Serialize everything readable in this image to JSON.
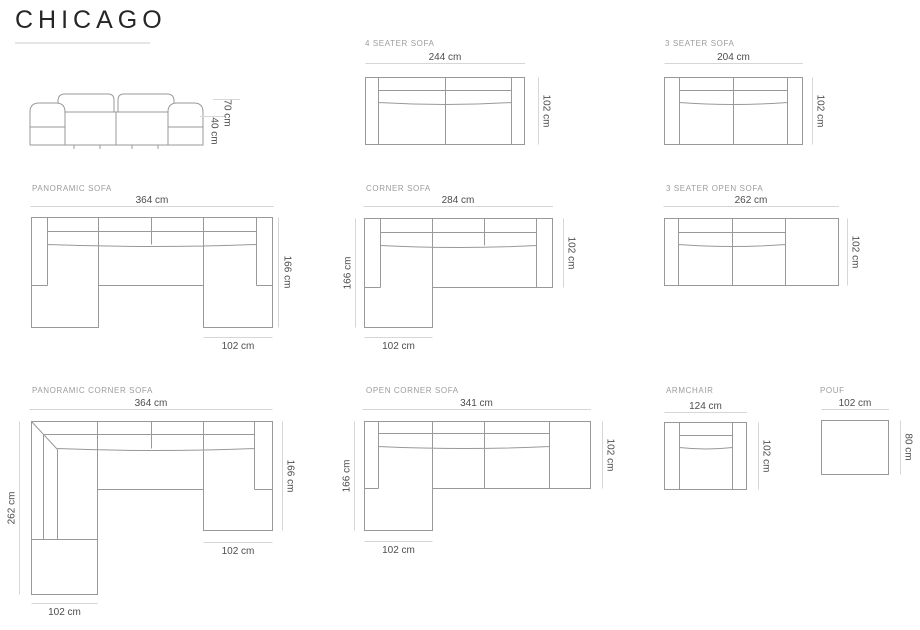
{
  "title": "CHICAGO",
  "side_view": {
    "total_height": "70 cm",
    "seat_height": "40 cm"
  },
  "diagrams": {
    "four_seater": {
      "label": "4 SEATER SOFA",
      "width": "244 cm",
      "depth": "102 cm"
    },
    "three_seater": {
      "label": "3 SEATER SOFA",
      "width": "204 cm",
      "depth": "102 cm"
    },
    "panoramic": {
      "label": "PANORAMIC SOFA",
      "width": "364 cm",
      "depth": "166 cm",
      "chaise_width": "102 cm"
    },
    "corner": {
      "label": "CORNER SOFA",
      "width": "284 cm",
      "depth": "166 cm",
      "end_depth": "102 cm",
      "chaise_width": "102 cm"
    },
    "three_seater_open": {
      "label": "3 SEATER OPEN SOFA",
      "width": "262 cm",
      "depth": "102 cm"
    },
    "panoramic_corner": {
      "label": "PANORAMIC CORNER SOFA",
      "width": "364 cm",
      "left_depth": "262 cm",
      "right_depth": "166 cm",
      "right_chaise_width": "102 cm",
      "bottom_chaise_width": "102 cm"
    },
    "open_corner": {
      "label": "OPEN CORNER SOFA",
      "width": "341 cm",
      "depth": "166 cm",
      "end_depth": "102 cm",
      "chaise_width": "102 cm"
    },
    "armchair": {
      "label": "ARMCHAIR",
      "width": "124 cm",
      "depth": "102 cm"
    },
    "pouf": {
      "label": "POUF",
      "width": "102 cm",
      "depth": "80 cm"
    }
  },
  "colors": {
    "outline": "#98999b",
    "dimension_line": "#d6d6d6",
    "dimension_text": "#4d4d4f",
    "label_text": "#9c9c9c",
    "title_text": "#262626",
    "title_underline": "#e6e6e6"
  }
}
